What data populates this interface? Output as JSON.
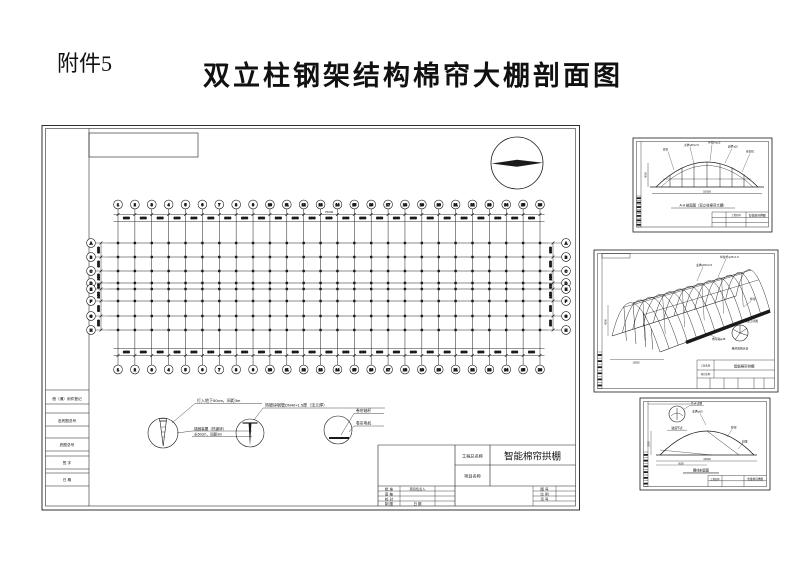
{
  "page": {
    "attachment_label": "附件5",
    "title": "双立柱钢架结构棉帘大棚剖面图",
    "ink": "#1a1a1a"
  },
  "main_sheet": {
    "grid": {
      "column_count": 26,
      "bay_dim": "3000",
      "total_dim": "75000",
      "row_letters": [
        "A",
        "B",
        "C",
        "D",
        "E",
        "F",
        "G",
        "H"
      ],
      "row_dims": [
        "3000",
        "3000",
        "2400",
        "900",
        "2400",
        "3000",
        "3000"
      ]
    },
    "details": [
      {
        "label_top": "打入地下50cm，间距3m",
        "label_right_1": "锚固装置（热镀锌）",
        "label_right_2": "长50cm，间距3m"
      },
      {
        "label_top": "热镀锌钢管DN40×1.5厚（法兰焊）"
      },
      {
        "label_1": "卷帘轴杆",
        "label_2": "卷帘电机"
      }
    ],
    "title_block": {
      "project_label": "工程总名称",
      "project_value": "智能棉帘拱棚",
      "item_label": "项目名称",
      "sign_rows": [
        "批 准",
        "审 核",
        "校 对",
        "制 图"
      ],
      "leader_label": "项目负责人",
      "date_label": "日 期",
      "right_rows": [
        "图 号",
        "比 例",
        "页 号"
      ]
    },
    "side_strip": [
      "借（通）用件登记",
      "旧底图总号",
      "底图总号",
      "签 字",
      "日 期"
    ]
  },
  "panel_section": {
    "annotations": [
      "棉帘",
      "主拱φ60×2.5",
      "纵拉杆φ25",
      "副拱φ25",
      "卷帘机"
    ],
    "span_dim": "10000",
    "height_dim": "4500",
    "title": "A-A 剖面图（双立柱棉帘大棚）",
    "block_label": "工程名称",
    "block_value": "智能棉帘拱棚"
  },
  "panel_axon": {
    "annotations": [
      "主拱φ60×2.5",
      "纵拉杆φ25×1.5",
      "棉帘",
      "卷帘轴φ48",
      "固定点详图"
    ],
    "wheel_caption": "卷帘机构示意",
    "span_dim": "10000",
    "height_dim": "4500",
    "block_label_1": "工程名称",
    "block_label_2": "项目名称",
    "block_value": "智能棉帘拱棚"
  },
  "panel_arch": {
    "detail_label": "节点详图",
    "detail_caption": "锚固节点",
    "annotations": [
      "主拱φ60",
      "棉帘",
      "斜撑"
    ],
    "span_dim": "10000",
    "half_dim": "5000",
    "height_dim": "3200",
    "title": "棚体剖面图",
    "block_label": "工程名称",
    "block_value": "智能棉帘拱棚"
  }
}
